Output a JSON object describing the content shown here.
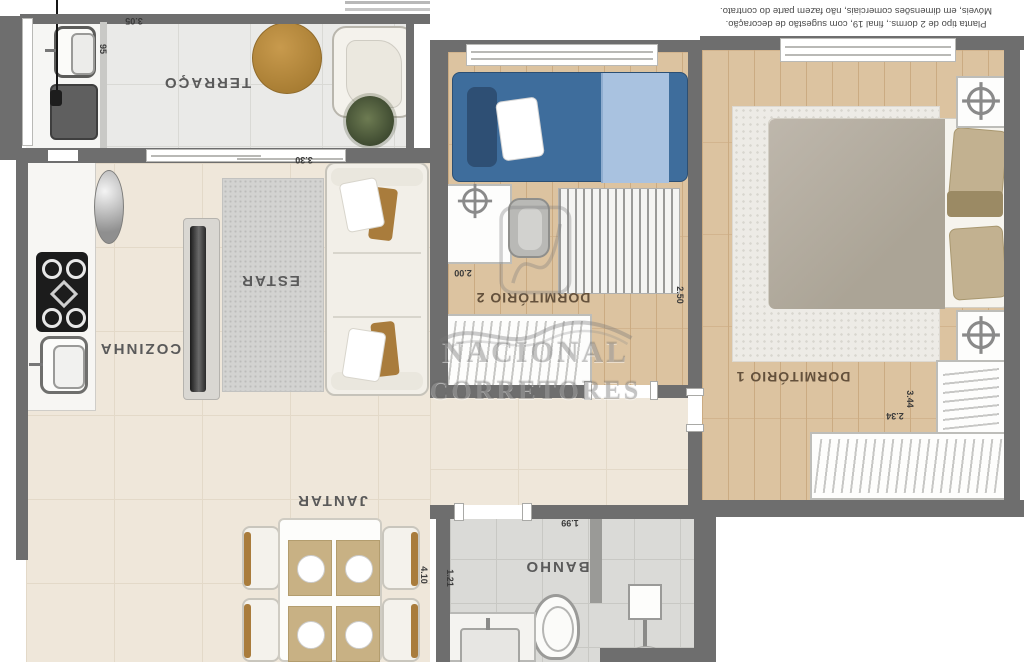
{
  "disclaimer": {
    "line1": "Planta tipo de 2 dorms., final 19, com sugestão de decoração.",
    "line2": "Móveis, em dimensões comerciais, não fazem parte do contrato."
  },
  "watermark": {
    "line1": "NACIONAL",
    "line2": "CORRETORES"
  },
  "rooms": {
    "terraco": {
      "label": "TERRAÇO",
      "width": "3.05",
      "depth": "95"
    },
    "estar": {
      "label": "ESTAR",
      "width": "3.30"
    },
    "cozinha": {
      "label": "COZINHA"
    },
    "jantar": {
      "label": "JANTAR",
      "length": "4.10"
    },
    "dorm2": {
      "label": "DORMITÓRIO 2",
      "width": "2.00",
      "depth": "2.50"
    },
    "dorm1": {
      "label": "DORMITÓRIO 1",
      "depth": "3.44",
      "width": "2.34"
    },
    "banho": {
      "label": "BANHO",
      "width": "1.99",
      "depth": "1.21"
    }
  },
  "colors": {
    "wall": "#6e6e6e",
    "floor_cream": "#efe7da",
    "floor_wood": "#dcc3a0",
    "floor_terrace": "#eaeae8",
    "floor_bath": "#dadad7",
    "bed_blue": "#3e6d9c",
    "bed_blue_light": "#a9c2e0",
    "wood_accent": "#b78c3f",
    "duvet_gray": "#b6afa4"
  }
}
